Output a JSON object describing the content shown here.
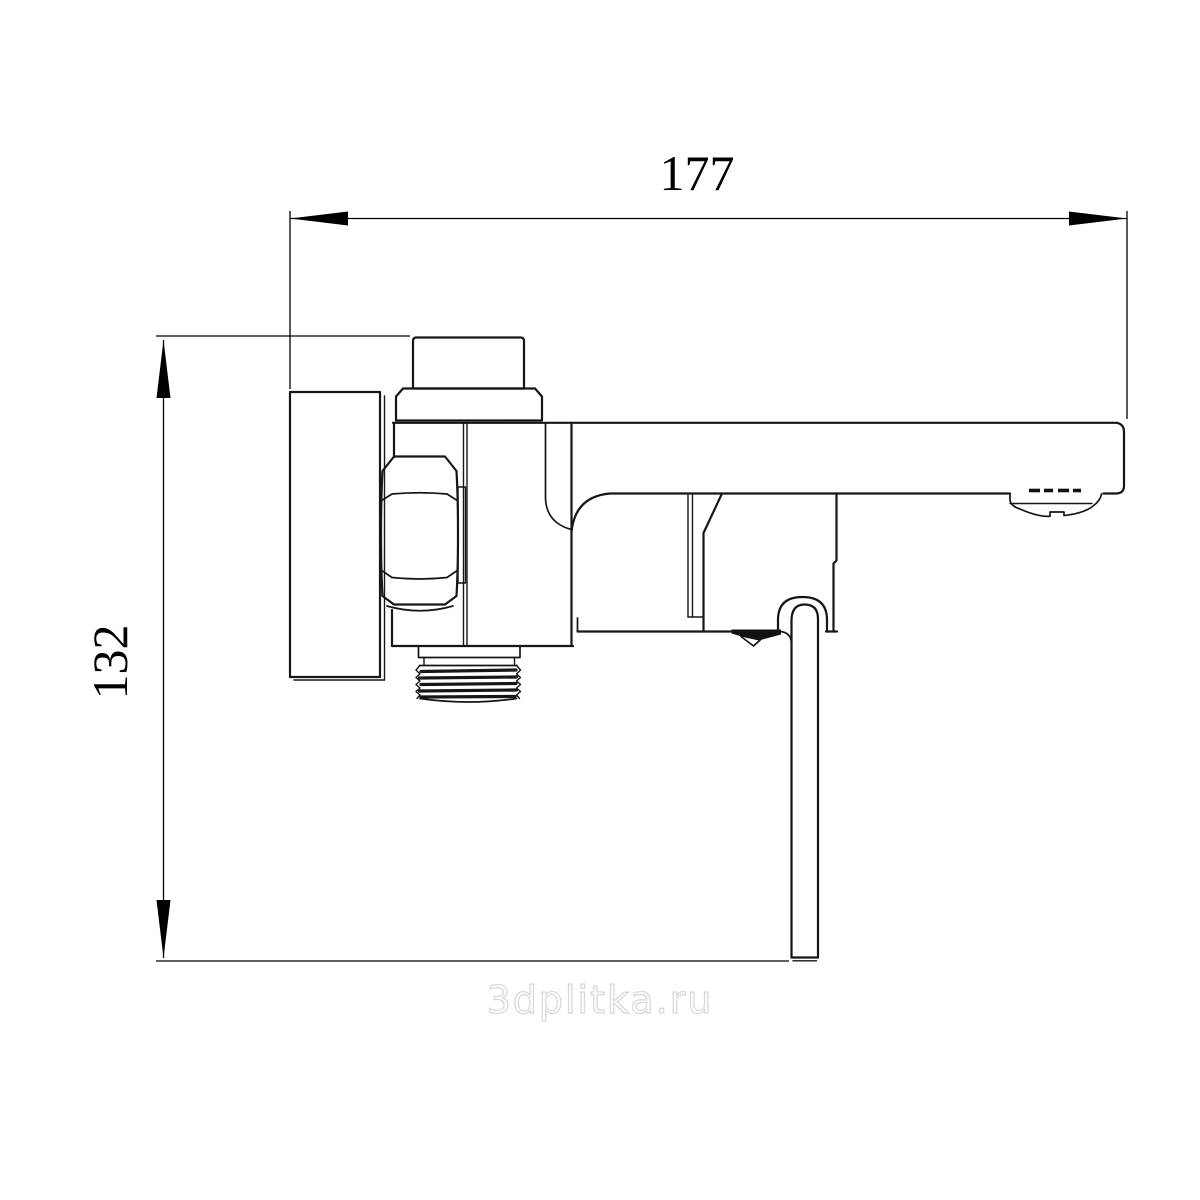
{
  "page": {
    "background": "#ffffff",
    "line_color": "#161616",
    "dimension_color": "#000000",
    "watermark_color": "#d9d9d9"
  },
  "drawing": {
    "dim_horizontal": "177",
    "dim_vertical": "132",
    "watermark": "3dplitka.ru"
  }
}
